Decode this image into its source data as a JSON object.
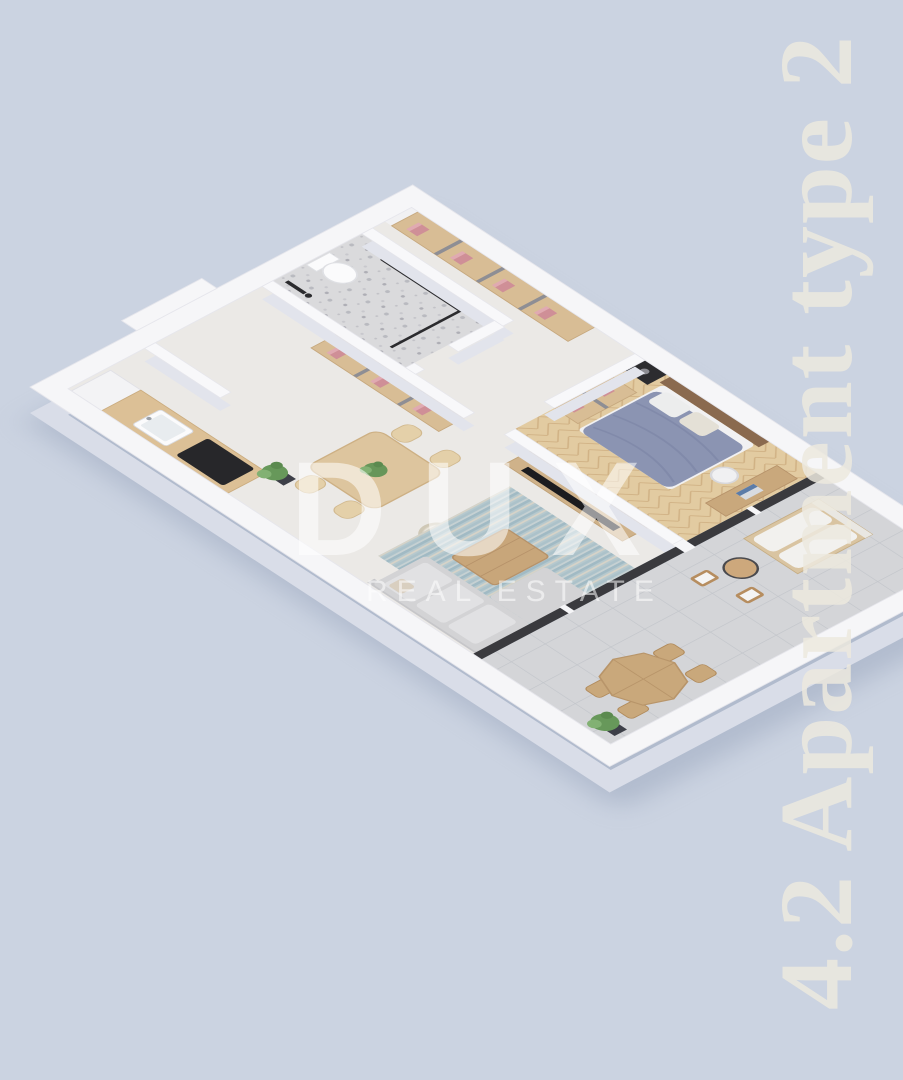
{
  "scene": {
    "kind": "isometric-apartment-floorplan-render",
    "background_color": "#cbd3e1",
    "rooms": [
      "entry-hall",
      "bathroom",
      "hallway-wardrobes",
      "kitchen",
      "dining-area",
      "living-room",
      "bedroom",
      "terrace"
    ]
  },
  "watermark": {
    "brand": "DUX",
    "tagline": "REAL ESTATE",
    "color": "#ffffff"
  },
  "side_label": {
    "text": "4.2 Apartment type 2",
    "color": "#ece9de"
  },
  "palette": {
    "background": "#cbd3e1",
    "wall_top": "#f6f6f8",
    "wall_side": "#d9dde8",
    "interior_wall_side": "#e2e4ec",
    "floor_indoor": "#ebe9e6",
    "floor_bathroom_terrazzo": "#dadadc",
    "floor_bedroom_herringbone": "#e2cba1",
    "floor_terrace_tile": "#d4d5d8",
    "wood_light": "#dcc096",
    "wood_medium": "#c9a87b",
    "wood_dark_headboard": "#8a6a4f",
    "bed_duvet_blue": "#8b94b2",
    "rug_teal": "#a9c0c8",
    "sofa_gray": "#d3d3d5",
    "clothes_pink": "#cf8f97",
    "plant_green": "#67985a",
    "fixture_black": "#2c2c2f",
    "glazing_dark": "#3a3a3e",
    "shadow": "#98a4bb"
  }
}
